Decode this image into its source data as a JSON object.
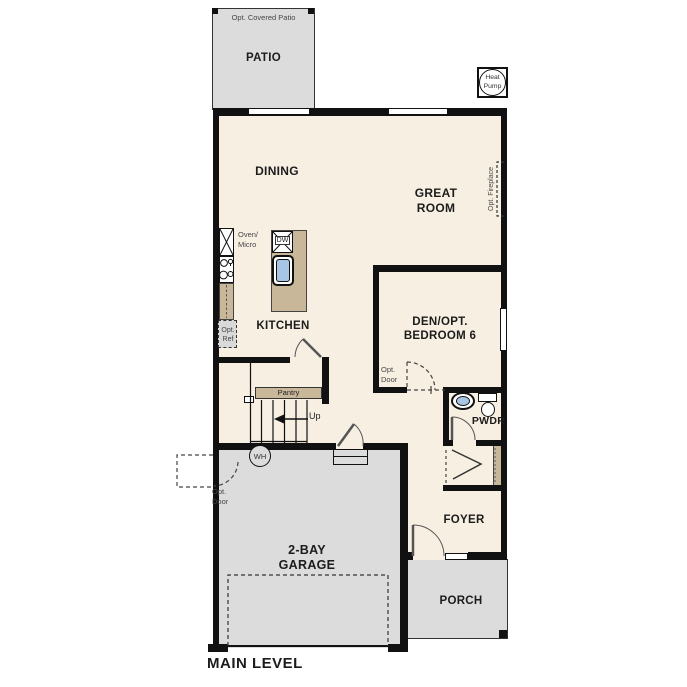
{
  "title": "MAIN LEVEL",
  "rooms": {
    "patio": "PATIO",
    "patio_option": "Opt. Covered Patio",
    "dining": "DINING",
    "great_room": "GREAT ROOM",
    "kitchen": "KITCHEN",
    "den": "DEN/OPT. BEDROOM 6",
    "powder": "PWDR",
    "foyer": "FOYER",
    "porch": "PORCH",
    "garage": "2-BAY GARAGE"
  },
  "fixtures": {
    "heat_pump": "Heat Pump",
    "opt_fireplace": "Opt. Fireplace",
    "oven_micro": "Oven/ Micro",
    "dishwasher": "DW",
    "opt_ref": "Opt. Ref",
    "pantry": "Pantry",
    "stairs_up": "Up",
    "water_heater": "WH",
    "opt_door_garage": "Opt. Door",
    "opt_door_den": "Opt. Door"
  },
  "colors": {
    "wall": "#111111",
    "floor": "#f7efe2",
    "exterior": "#dcdcdc",
    "counter": "#c9b79a",
    "sink_blue": "#a8c6e4"
  }
}
